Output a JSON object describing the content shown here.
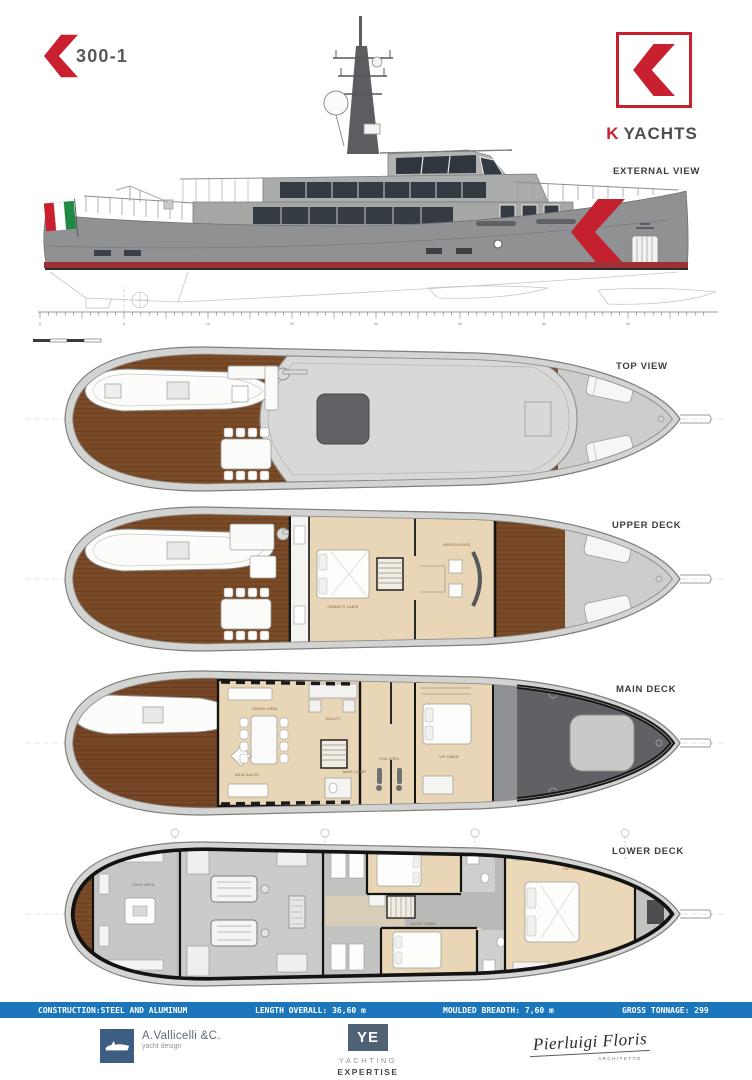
{
  "header": {
    "model": "300-1",
    "brand_k": "K",
    "brand_rest": "YACHTS"
  },
  "views": {
    "external": {
      "label": "EXTERNAL VIEW"
    },
    "top": {
      "label": "TOP VIEW"
    },
    "upper": {
      "label": "UPPER DECK"
    },
    "main": {
      "label": "MAIN DECK"
    },
    "lower": {
      "label": "LOWER DECK"
    }
  },
  "rooms": {
    "upper": {
      "owner": "OWNER'S CABIN",
      "wheelhouse": "WHEELHOUSE"
    },
    "main": {
      "salon": "MAIN SALON",
      "dining": "DINING AREA",
      "galley": "GALLEY",
      "lobby": "MAIN LOBBY",
      "gym": "GYM AREA",
      "vip": "VIP CABIN"
    },
    "lower": {
      "crew": "CREW AREA",
      "guest1": "GUEST CABIN",
      "guest2": "GUEST CABIN",
      "vip": "VIP CABIN"
    }
  },
  "specs": {
    "construction": "CONSTRUCTION:STEEL AND ALUMINUM",
    "length": "LENGTH OVERALL: 36,60 m",
    "breadth": "MOULDED BREADTH: 7,60 m",
    "tonnage": "GROSS TONNAGE: 299"
  },
  "footer": {
    "vallicelli_name": "A.Vallicelli &C.",
    "vallicelli_sub": "yacht design",
    "ye_initials": "YE",
    "ye_line1": "YACHTING",
    "ye_line2": "EXPERTISE",
    "signature_name": "Pierluigi Floris",
    "signature_title": "ARCHITETTO"
  },
  "colors": {
    "brand_red": "#c8202f",
    "spec_bar_blue": "#1b76bc",
    "hull_gray": "#8f9193",
    "wood_brown": "#7b4b27",
    "interior_beige": "#e9d6b6"
  }
}
